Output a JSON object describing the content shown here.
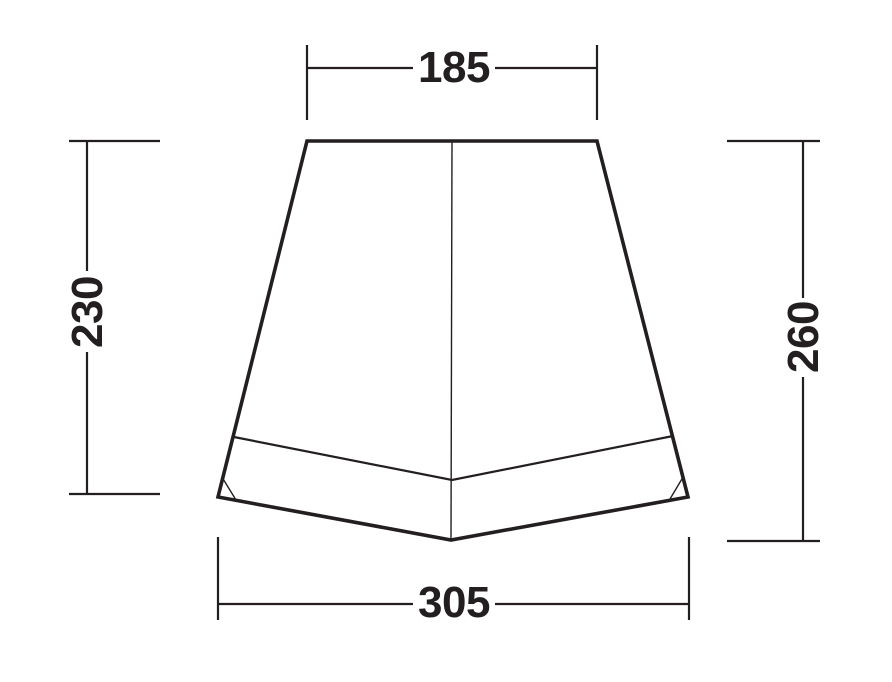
{
  "diagram": {
    "kind": "tent-front-elevation-dimension-drawing",
    "background_color": "#ffffff",
    "line_color": "#231f20",
    "labels": {
      "top_width": "185",
      "left_height": "230",
      "right_height": "260",
      "bottom_width": "305"
    }
  }
}
